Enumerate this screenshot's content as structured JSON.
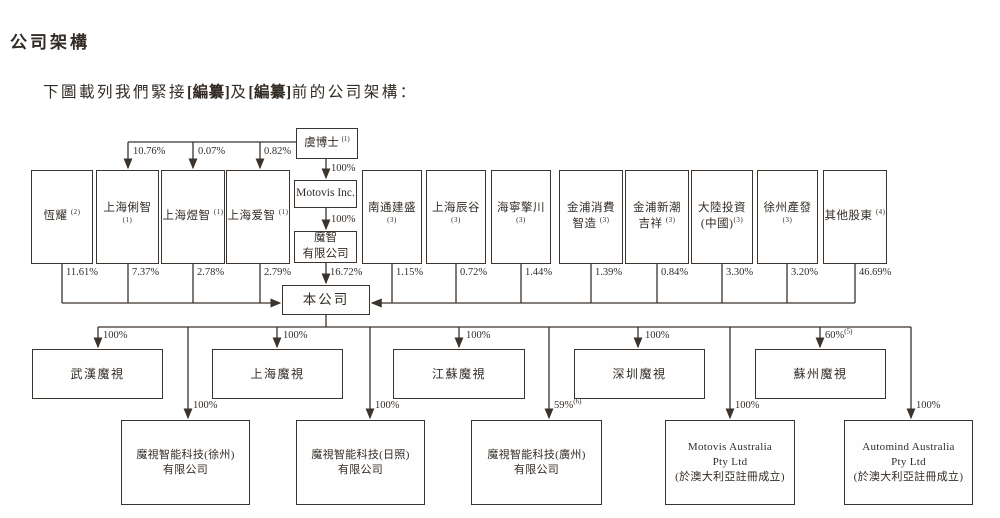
{
  "page": {
    "title": "公司架構",
    "intro_pre": "下圖載列我們緊接",
    "intro_redact1": "[編纂]",
    "intro_and": "及",
    "intro_redact2": "[編纂]",
    "intro_post": "前的公司架構："
  },
  "nodes": {
    "founder": {
      "label": "虞博士",
      "sup": "(1)"
    },
    "motovis_inc": {
      "label": "Motovis Inc."
    },
    "mozhi": {
      "line1": "魔智",
      "line2": "有限公司"
    },
    "company": {
      "label": "本公司"
    },
    "hengyao": {
      "label": "恆耀",
      "sup": "(2)"
    },
    "shanghai_lizhi": {
      "label": "上海俐智",
      "sup": "(1)"
    },
    "shanghai_yuzhi": {
      "label": "上海煜智",
      "sup": "(1)"
    },
    "shanghai_aizhi": {
      "label": "上海爱智",
      "sup": "(1)"
    },
    "nantong_jiansheng": {
      "label": "南通建盛",
      "sup": "(3)"
    },
    "shanghai_chengu": {
      "label": "上海辰谷",
      "sup": "(3)"
    },
    "haining_qingchuan": {
      "label": "海寧擎川",
      "sup": "(3)"
    },
    "jinpu_xiaofei": {
      "line1": "金浦消費",
      "line2": "智造",
      "sup": "(3)"
    },
    "jinpu_xinchao": {
      "line1": "金浦新潮",
      "line2": "吉祥",
      "sup": "(3)"
    },
    "dalu_touzi": {
      "line1": "大陸投資",
      "line2": "(中國)",
      "sup": "(3)"
    },
    "xuzhou_chanfa": {
      "label": "徐州產發",
      "sup": "(3)"
    },
    "other_shareholders": {
      "label": "其他股東",
      "sup": "(4)"
    },
    "wuhan": {
      "label": "武漢魔視"
    },
    "shanghai_motovis": {
      "label": "上海魔視"
    },
    "jiangsu": {
      "label": "江蘇魔視"
    },
    "shenzhen": {
      "label": "深圳魔視"
    },
    "suzhou": {
      "label": "蘇州魔視"
    },
    "xuzhou_co": {
      "line1": "魔視智能科技(徐州)",
      "line2": "有限公司"
    },
    "rizhao_co": {
      "line1": "魔視智能科技(日照)",
      "line2": "有限公司"
    },
    "guangzhou_co": {
      "line1": "魔視智能科技(廣州)",
      "line2": "有限公司"
    },
    "motovis_au": {
      "line1": "Motovis Australia",
      "line2": "Pty Ltd",
      "line3": "(於澳大利亞註冊成立)"
    },
    "automind_au": {
      "line1": "Automind Australia",
      "line2": "Pty Ltd",
      "line3": "(於澳大利亞註冊成立)"
    }
  },
  "pcts": {
    "founder_to_lizhi": "10.76%",
    "founder_to_yuzhi": "0.07%",
    "founder_to_aizhi": "0.82%",
    "founder_to_motovis": "100%",
    "motovis_to_mozhi": "100%",
    "hengyao": "11.61%",
    "lizhi": "7.37%",
    "yuzhi": "2.78%",
    "aizhi": "2.79%",
    "mozhi": "16.72%",
    "nantong": "1.15%",
    "chengu": "0.72%",
    "qingchuan": "1.44%",
    "jinpu_xiaofei": "1.39%",
    "jinpu_xinchao": "0.84%",
    "dalu": "3.30%",
    "xuzhou_chanfa": "3.20%",
    "other": "46.69%",
    "wuhan": "100%",
    "shanghai": "100%",
    "jiangsu": "100%",
    "shenzhen": "100%",
    "suzhou": "60%",
    "suzhou_sup": "(5)",
    "xuzhou_co": "100%",
    "rizhao_co": "100%",
    "guangzhou_co": "59%",
    "guangzhou_sup": "(6)",
    "motovis_au": "100%",
    "automind_au": "100%"
  },
  "colors": {
    "line": "#3b332c",
    "text": "#332c26",
    "background": "#ffffff"
  }
}
